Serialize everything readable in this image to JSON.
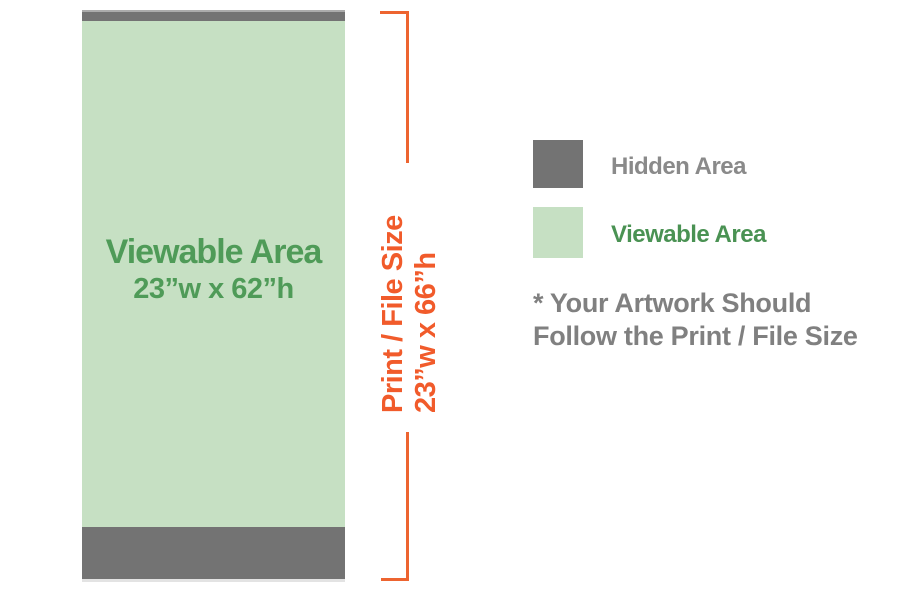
{
  "banner": {
    "viewable_label": "Viewable Area",
    "viewable_size": "23”w x 62”h"
  },
  "bracket": {
    "label": "Print / File Size",
    "size": "23”w x 66”h"
  },
  "legend": {
    "items": [
      {
        "label": "Hidden Area",
        "color": "#737373"
      },
      {
        "label": "Viewable Area",
        "color": "#c6e0c3"
      }
    ]
  },
  "note": {
    "line1": "* Your Artwork Should",
    "line2": "Follow the Print / File Size"
  },
  "colors": {
    "hidden_gray": "#737373",
    "viewable_green": "#c6e0c3",
    "green_text": "#4f9b58",
    "orange": "#f15b2b",
    "note_gray": "#808080"
  }
}
